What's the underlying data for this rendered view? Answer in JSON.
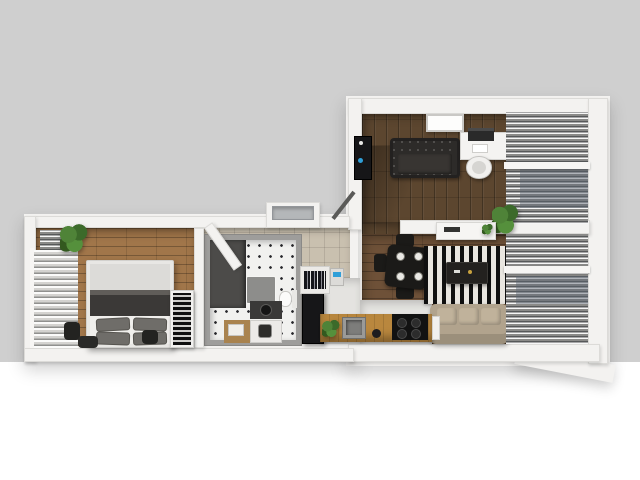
{
  "scene": {
    "type": "3d-apartment-floorplan-render",
    "view": "top-down bird's-eye 3D render, no text labels",
    "canvas": {
      "width": 640,
      "height": 480
    },
    "background_color": "#ffffff",
    "stage_band": {
      "color": "#cfcfcf",
      "top": 58,
      "height": 362
    },
    "balcony_glass_edge": {
      "color": "#39434e",
      "x": 601,
      "y": 153,
      "height": 172
    }
  },
  "palette": {
    "exterior_wall": "#f3f2f0",
    "interior_wall_gray": "#9e9d9b",
    "office_floor_wood": "#5c462f",
    "living_floor_wood": "#6e5138",
    "bedroom_floor_wood": "#a1764a",
    "hallway_tile_tan": "#c9c0af",
    "kitchen_floor_light": "#e4e3e0",
    "bathroom_tile_white": "#f1f1ef",
    "shower_dark": "#4c4b49",
    "shower_tray_gray": "#8d8d8b",
    "counter_wood": "#b9873e",
    "sofa_beige": "#b1a38d",
    "sofa_cushion_beige": "#c0b29b",
    "chesterfield_dark": "#2d2b29",
    "dining_set_black": "#1b1a18",
    "rug_black": "#101010",
    "rug_white": "#e9e6e0",
    "blinds_gray": "#8c8c8a",
    "blinds_pale": "#d9d8d5",
    "window_glass": "#5a6470",
    "appliance_black": "#161618",
    "accent_blue": "#2f9fd8",
    "plant_green": "#4f8338",
    "blanket_dark": "#3b3937",
    "pillow_gray": "#6f6d69",
    "bed_linen": "#f0efec"
  },
  "apartment": {
    "shape": "L-shaped, long bedroom wing on the left, office and living wing on the right",
    "rooms": [
      {
        "id": "office",
        "label": "Office",
        "floor": "dark wood planks",
        "furniture": [
          "tufted chesterfield sofa",
          "black cabinet with blue LED",
          "white desk",
          "printer",
          "white office chair",
          "ceiling lamp",
          "venetian window blinds",
          "potted plant",
          "open door leaf"
        ]
      },
      {
        "id": "living-dining",
        "label": "Living / dining room",
        "floor": "brown wood planks",
        "furniture": [
          "white sideboard console",
          "black dining table with four place settings",
          "four black chairs",
          "black-and-white striped rug",
          "dark coffee table",
          "three-seat beige sofa",
          "wooden side table with speaker",
          "venetian window blinds"
        ]
      },
      {
        "id": "kitchen",
        "label": "Kitchen",
        "floor": "light gray",
        "furniture": [
          "tall black fridge cabinet",
          "white cabinet with wine-bottle rack",
          "small appliance with blue display",
          "wooden countertop",
          "sink",
          "induction hob with four burners",
          "potted herb plant",
          "kettle"
        ]
      },
      {
        "id": "hallway",
        "label": "Entrance hallway",
        "floor": "tan tiles",
        "furniture": [
          "recessed entrance door",
          "angled partition wall"
        ]
      },
      {
        "id": "bathroom",
        "label": "Bathroom",
        "floor": "white tiles with black dot pattern",
        "furniture": [
          "dark walk-in shower",
          "gray shower tray",
          "wall-hung toilet",
          "dark vanity with round basin",
          "washing machine",
          "wooden cabinet"
        ]
      },
      {
        "id": "bedroom",
        "label": "Bedroom",
        "floor": "tan wood planks",
        "furniture": [
          "double bed with dark blanket and four gray pillows",
          "horizontal window blinds",
          "radiator panel",
          "potted plant",
          "slatted storage shelf",
          "dark bags and speaker on floor"
        ]
      }
    ]
  }
}
